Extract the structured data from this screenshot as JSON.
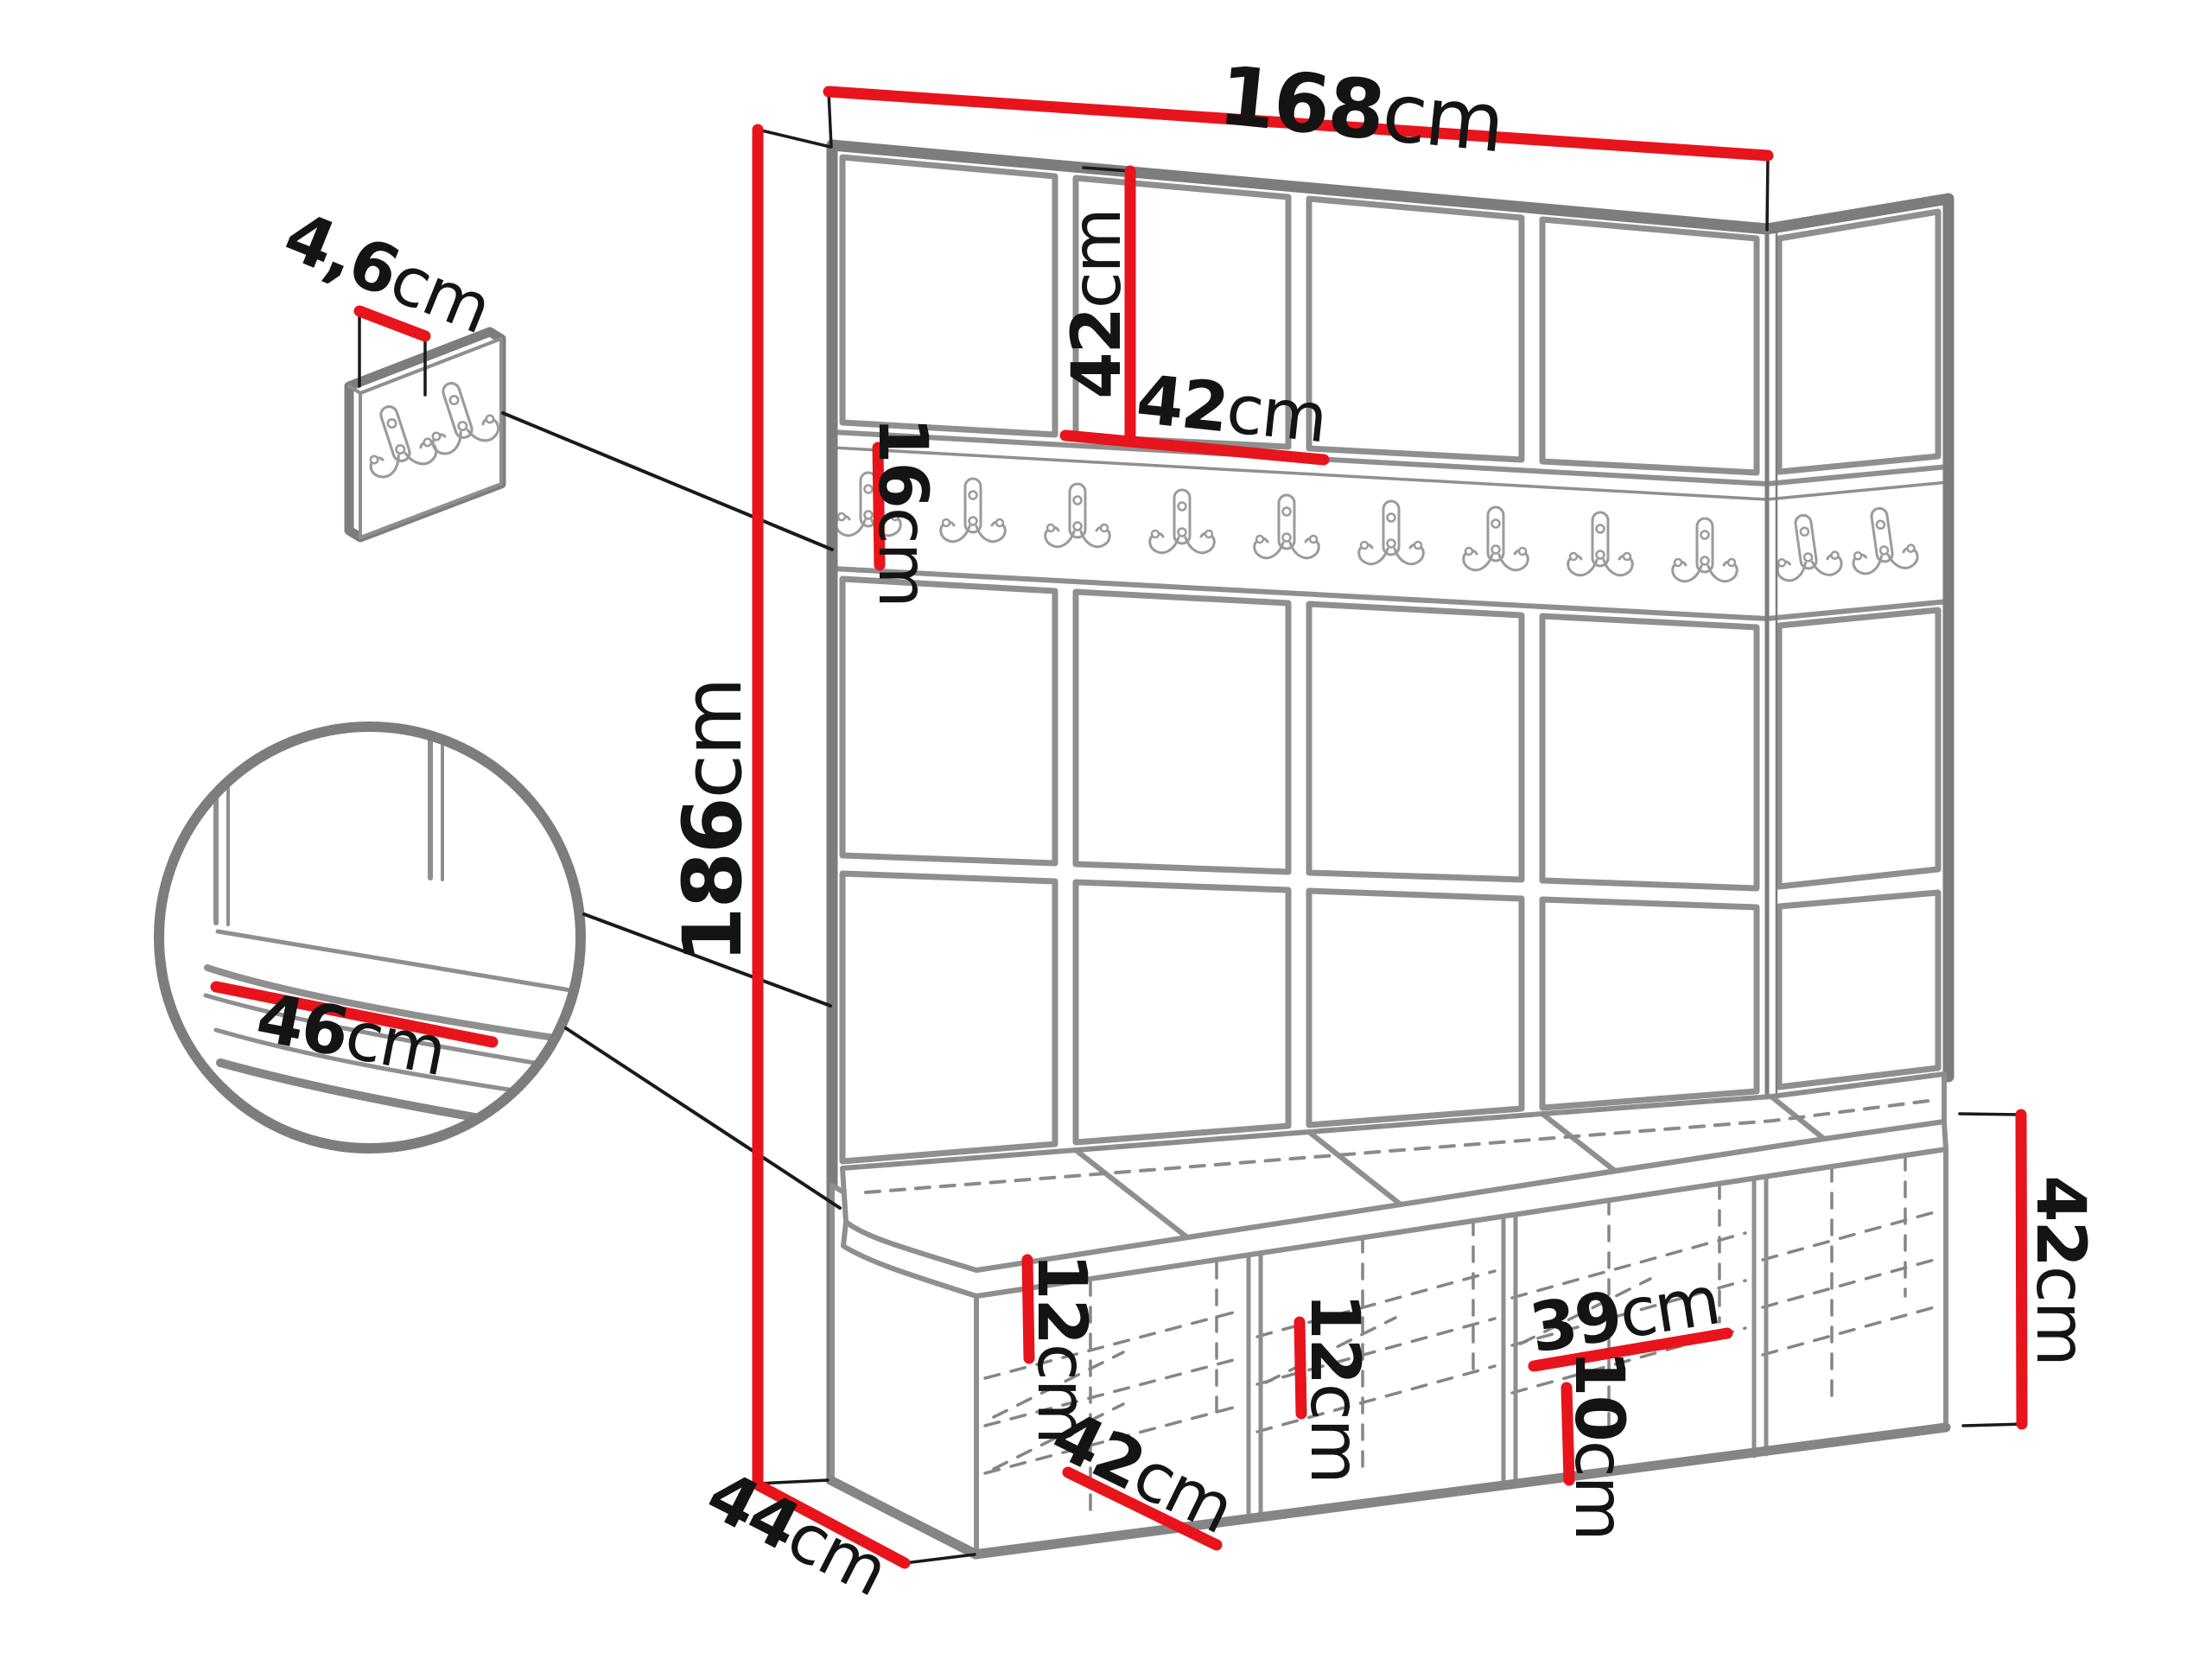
{
  "diagram": {
    "type": "furniture-dimension-diagram",
    "product": "hallway-set-wall-panels-hook-rail-shoe-bench",
    "dimensions": {
      "top_width": {
        "value": "168",
        "unit": "cm"
      },
      "panel_height": {
        "value": "42",
        "unit": "cm"
      },
      "panel_width": {
        "value": "42",
        "unit": "cm"
      },
      "rail_height": {
        "value": "16",
        "unit": "cm"
      },
      "total_height": {
        "value": "186",
        "unit": "cm"
      },
      "hook_panel_thickness": {
        "value": "4,6",
        "unit": "cm"
      },
      "seat_depth": {
        "value": "46",
        "unit": "cm"
      },
      "cubby1_shelf_spacing": {
        "value": "12",
        "unit": "cm"
      },
      "cubby_width": {
        "value": "42",
        "unit": "cm"
      },
      "cubby2_shelf_spacing": {
        "value": "12",
        "unit": "cm"
      },
      "cubby_inner_width": {
        "value": "39",
        "unit": "cm"
      },
      "cubby_bottom_spacing": {
        "value": "10",
        "unit": "cm"
      },
      "bench_height": {
        "value": "42",
        "unit": "cm"
      },
      "bench_depth": {
        "value": "44",
        "unit": "cm"
      }
    },
    "colors": {
      "dimension_line": "#e8141c",
      "outline": "#8a8a8a",
      "text": "#141414",
      "background": "#ffffff"
    }
  }
}
